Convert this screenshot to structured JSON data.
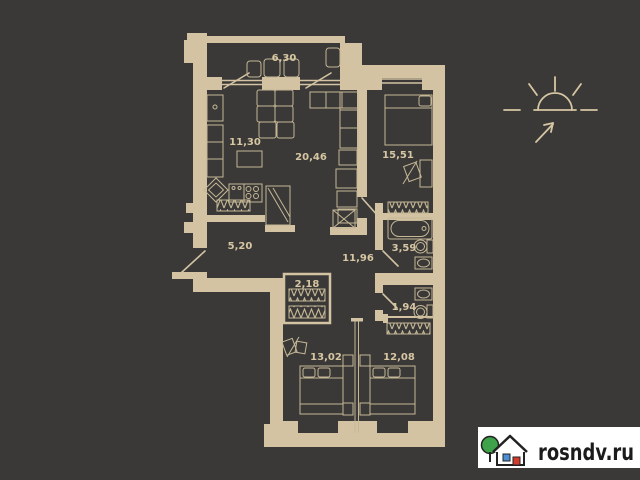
{
  "colors": {
    "background": "#3a3938",
    "wall": "#d3c3a2",
    "furniture_line": "#c6b896",
    "label_text": "#d6c6a2",
    "logo_background": "#ffffff",
    "logo_text": "#1b1b1b",
    "logo_tree_green": "#3da24a",
    "logo_window_blue": "#4a8fd3",
    "logo_door_red": "#d13c2c"
  },
  "floorplan": {
    "rooms": [
      {
        "name": "balcony",
        "area": "6,30"
      },
      {
        "name": "kitchen",
        "area": "11,30"
      },
      {
        "name": "living-room",
        "area": "20,46"
      },
      {
        "name": "bedroom-1",
        "area": "15,51"
      },
      {
        "name": "hallway",
        "area": "5,20"
      },
      {
        "name": "corridor",
        "area": "11,96"
      },
      {
        "name": "bathroom",
        "area": "3,59"
      },
      {
        "name": "closet",
        "area": "2,18"
      },
      {
        "name": "wc",
        "area": "1,94"
      },
      {
        "name": "bedroom-2",
        "area": "13,02"
      },
      {
        "name": "bedroom-3",
        "area": "12,08"
      }
    ],
    "icons": [
      {
        "name": "sun-direction-icon"
      },
      {
        "name": "house-logo-icon"
      }
    ]
  },
  "watermark": {
    "site": "rosndv.ru"
  }
}
